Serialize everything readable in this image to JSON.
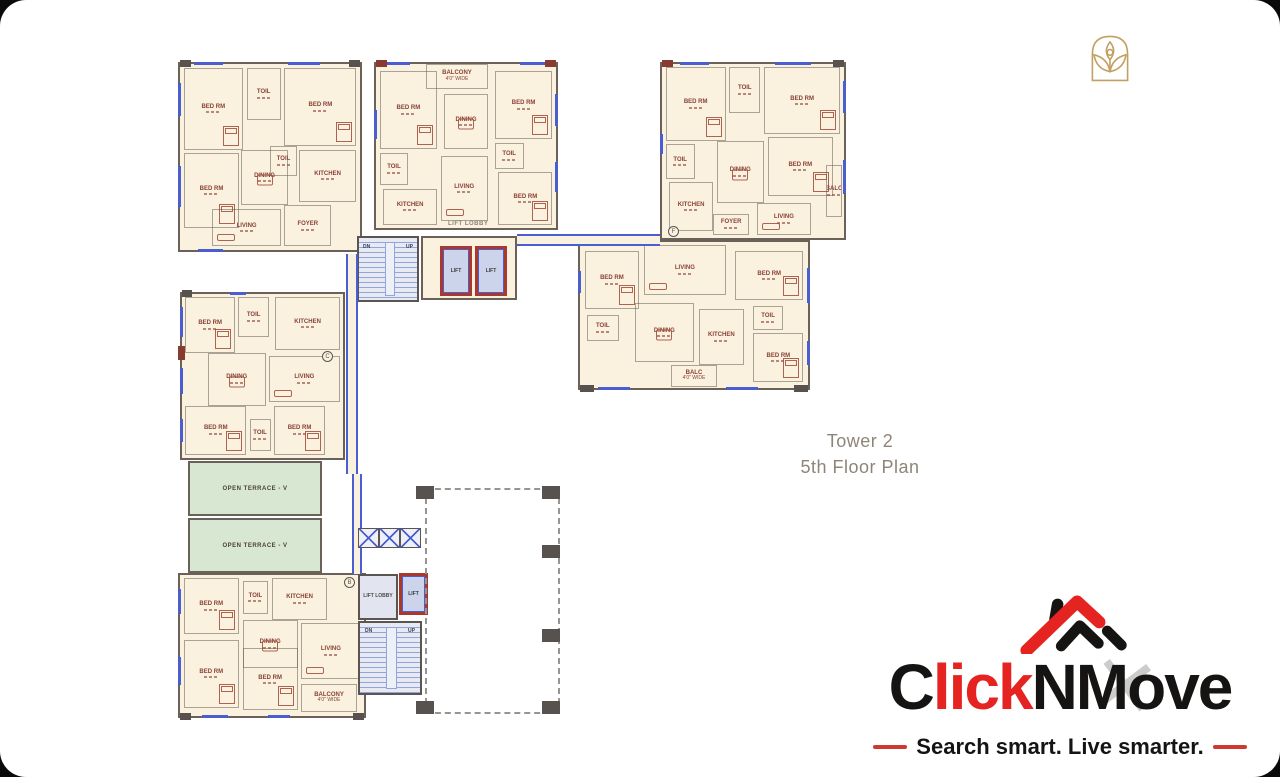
{
  "plan": {
    "title": {
      "line1": "Tower 2",
      "line2": "5th Floor Plan"
    },
    "labels": {
      "lift_lobby": "LIFT LOBBY",
      "lift": "LIFT",
      "up": "UP",
      "dn": "DN"
    },
    "terraces": [
      {
        "label": "OPEN TERRACE - V",
        "x": 188,
        "y": 461,
        "w": 134,
        "h": 55
      },
      {
        "label": "OPEN TERRACE - V",
        "x": 188,
        "y": 518,
        "w": 134,
        "h": 55
      }
    ],
    "markers": [
      {
        "letter": "F",
        "x": 668,
        "y": 226
      },
      {
        "letter": "B",
        "x": 344,
        "y": 577
      },
      {
        "letter": "C",
        "x": 322,
        "y": 351
      }
    ],
    "wings": [
      {
        "name": "wing-top-left",
        "x": 178,
        "y": 62,
        "w": 184,
        "h": 190,
        "rooms": [
          {
            "label": "BED RM",
            "x": 2,
            "y": 2,
            "w": 33,
            "h": 44,
            "furn": "bed"
          },
          {
            "label": "TOIL",
            "x": 37,
            "y": 2,
            "w": 19,
            "h": 28
          },
          {
            "label": "BED RM",
            "x": 58,
            "y": 2,
            "w": 40,
            "h": 42,
            "furn": "bed"
          },
          {
            "label": "BED RM",
            "x": 2,
            "y": 48,
            "w": 31,
            "h": 40,
            "furn": "bed"
          },
          {
            "label": "TOIL",
            "x": 50,
            "y": 44,
            "w": 15,
            "h": 16
          },
          {
            "label": "DINING",
            "x": 34,
            "y": 46,
            "w": 26,
            "h": 30,
            "furn": "table"
          },
          {
            "label": "KITCHEN",
            "x": 66,
            "y": 46,
            "w": 32,
            "h": 28
          },
          {
            "label": "LIVING",
            "x": 18,
            "y": 78,
            "w": 38,
            "h": 20,
            "furn": "sofa"
          },
          {
            "label": "FOYER",
            "x": 58,
            "y": 76,
            "w": 26,
            "h": 22
          }
        ],
        "windows": [
          {
            "s": "top",
            "p": 8,
            "l": 16
          },
          {
            "s": "top",
            "p": 60,
            "l": 18
          },
          {
            "s": "left",
            "p": 10,
            "l": 18
          },
          {
            "s": "left",
            "p": 55,
            "l": 22
          },
          {
            "s": "bottom",
            "p": 10,
            "l": 14
          },
          {
            "s": "top",
            "p": 0,
            "l": 6,
            "t": "col",
            "c": "#57524e"
          },
          {
            "s": "top",
            "p": 94,
            "l": 6,
            "t": "col",
            "c": "#57524e"
          }
        ]
      },
      {
        "name": "wing-top-middle",
        "x": 374,
        "y": 62,
        "w": 184,
        "h": 168,
        "rooms": [
          {
            "label": "BALCONY",
            "dim": "4'0\" WIDE",
            "x": 28,
            "y": 0,
            "w": 34,
            "h": 15
          },
          {
            "label": "BED RM",
            "x": 2,
            "y": 4,
            "w": 32,
            "h": 48,
            "furn": "bed"
          },
          {
            "label": "BED RM",
            "x": 66,
            "y": 4,
            "w": 32,
            "h": 42,
            "furn": "bed"
          },
          {
            "label": "DINING",
            "x": 38,
            "y": 18,
            "w": 24,
            "h": 34,
            "furn": "table"
          },
          {
            "label": "TOIL",
            "x": 2,
            "y": 54,
            "w": 16,
            "h": 20
          },
          {
            "label": "KITCHEN",
            "x": 4,
            "y": 76,
            "w": 30,
            "h": 22
          },
          {
            "label": "LIVING",
            "x": 36,
            "y": 56,
            "w": 26,
            "h": 40,
            "furn": "sofa"
          },
          {
            "label": "TOIL",
            "x": 66,
            "y": 48,
            "w": 16,
            "h": 16
          },
          {
            "label": "BED RM",
            "x": 68,
            "y": 66,
            "w": 30,
            "h": 32,
            "furn": "bed"
          }
        ],
        "windows": [
          {
            "s": "top",
            "p": 5,
            "l": 14
          },
          {
            "s": "top",
            "p": 80,
            "l": 14
          },
          {
            "s": "left",
            "p": 28,
            "l": 18
          },
          {
            "s": "right",
            "p": 18,
            "l": 20
          },
          {
            "s": "right",
            "p": 60,
            "l": 18
          },
          {
            "s": "top",
            "p": 0,
            "l": 6,
            "t": "col",
            "c": "#8a3b31"
          },
          {
            "s": "top",
            "p": 94,
            "l": 6,
            "t": "col",
            "c": "#8a3b31"
          }
        ]
      },
      {
        "name": "wing-top-right",
        "x": 660,
        "y": 62,
        "w": 186,
        "h": 178,
        "rooms": [
          {
            "label": "BED RM",
            "x": 2,
            "y": 2,
            "w": 33,
            "h": 42,
            "furn": "bed"
          },
          {
            "label": "TOIL",
            "x": 37,
            "y": 2,
            "w": 17,
            "h": 26
          },
          {
            "label": "BED RM",
            "x": 56,
            "y": 2,
            "w": 42,
            "h": 38,
            "furn": "bed"
          },
          {
            "label": "TOIL",
            "x": 2,
            "y": 46,
            "w": 16,
            "h": 20
          },
          {
            "label": "KITCHEN",
            "x": 4,
            "y": 68,
            "w": 24,
            "h": 28
          },
          {
            "label": "DINING",
            "x": 30,
            "y": 44,
            "w": 26,
            "h": 36,
            "furn": "table"
          },
          {
            "label": "BED RM",
            "x": 58,
            "y": 42,
            "w": 36,
            "h": 34,
            "furn": "bed"
          },
          {
            "label": "LIVING",
            "x": 52,
            "y": 80,
            "w": 30,
            "h": 18,
            "furn": "sofa"
          },
          {
            "label": "FOYER",
            "x": 28,
            "y": 86,
            "w": 20,
            "h": 12
          },
          {
            "label": "BALC",
            "x": 90,
            "y": 58,
            "w": 9,
            "h": 30
          }
        ],
        "windows": [
          {
            "s": "top",
            "p": 10,
            "l": 16
          },
          {
            "s": "top",
            "p": 62,
            "l": 20
          },
          {
            "s": "right",
            "p": 10,
            "l": 18
          },
          {
            "s": "right",
            "p": 55,
            "l": 20
          },
          {
            "s": "left",
            "p": 40,
            "l": 12
          },
          {
            "s": "top",
            "p": 0,
            "l": 6,
            "t": "col",
            "c": "#8a3b31"
          },
          {
            "s": "top",
            "p": 94,
            "l": 6,
            "t": "col",
            "c": "#57524e"
          }
        ]
      },
      {
        "name": "wing-middle-right",
        "x": 578,
        "y": 240,
        "w": 232,
        "h": 150,
        "rooms": [
          {
            "label": "BED RM",
            "x": 2,
            "y": 6,
            "w": 24,
            "h": 40,
            "furn": "bed"
          },
          {
            "label": "LIVING",
            "x": 28,
            "y": 2,
            "w": 36,
            "h": 34,
            "furn": "sofa"
          },
          {
            "label": "BED RM",
            "x": 68,
            "y": 6,
            "w": 30,
            "h": 34,
            "furn": "bed"
          },
          {
            "label": "TOIL",
            "x": 3,
            "y": 50,
            "w": 14,
            "h": 18
          },
          {
            "label": "DINING",
            "x": 24,
            "y": 42,
            "w": 26,
            "h": 40,
            "furn": "table"
          },
          {
            "label": "KITCHEN",
            "x": 52,
            "y": 46,
            "w": 20,
            "h": 38
          },
          {
            "label": "TOIL",
            "x": 76,
            "y": 44,
            "w": 13,
            "h": 16
          },
          {
            "label": "BED RM",
            "x": 76,
            "y": 62,
            "w": 22,
            "h": 34,
            "furn": "bed"
          },
          {
            "label": "BALC",
            "dim": "4'0\" WIDE",
            "x": 40,
            "y": 84,
            "w": 20,
            "h": 15
          }
        ],
        "windows": [
          {
            "s": "bottom",
            "p": 8,
            "l": 14
          },
          {
            "s": "bottom",
            "p": 64,
            "l": 14
          },
          {
            "s": "left",
            "p": 20,
            "l": 15
          },
          {
            "s": "right",
            "p": 18,
            "l": 24
          },
          {
            "s": "right",
            "p": 68,
            "l": 16
          },
          {
            "s": "bottom",
            "p": 0,
            "l": 6,
            "t": "col",
            "c": "#57524e"
          },
          {
            "s": "bottom",
            "p": 94,
            "l": 6,
            "t": "col",
            "c": "#57524e"
          }
        ]
      },
      {
        "name": "wing-middle-left",
        "x": 180,
        "y": 292,
        "w": 165,
        "h": 168,
        "rooms": [
          {
            "label": "BED RM",
            "x": 2,
            "y": 2,
            "w": 31,
            "h": 34,
            "furn": "bed"
          },
          {
            "label": "TOIL",
            "x": 35,
            "y": 2,
            "w": 19,
            "h": 24
          },
          {
            "label": "KITCHEN",
            "x": 58,
            "y": 2,
            "w": 40,
            "h": 32
          },
          {
            "label": "DINING",
            "x": 16,
            "y": 36,
            "w": 36,
            "h": 32,
            "furn": "table"
          },
          {
            "label": "LIVING",
            "x": 54,
            "y": 38,
            "w": 44,
            "h": 28,
            "furn": "sofa"
          },
          {
            "label": "BED RM",
            "x": 2,
            "y": 68,
            "w": 38,
            "h": 30,
            "furn": "bed"
          },
          {
            "label": "TOIL",
            "x": 42,
            "y": 76,
            "w": 13,
            "h": 20
          },
          {
            "label": "BED RM",
            "x": 57,
            "y": 68,
            "w": 32,
            "h": 30,
            "furn": "bed"
          }
        ],
        "windows": [
          {
            "s": "left",
            "p": 8,
            "l": 18
          },
          {
            "s": "left",
            "p": 45,
            "l": 16
          },
          {
            "s": "left",
            "p": 76,
            "l": 14
          },
          {
            "s": "top",
            "p": 30,
            "l": 10
          },
          {
            "s": "left",
            "p": 32,
            "l": 8,
            "t": "col",
            "c": "#8a3b31"
          },
          {
            "s": "top",
            "p": 0,
            "l": 6,
            "t": "col",
            "c": "#57524e"
          }
        ]
      },
      {
        "name": "wing-bottom-left",
        "x": 178,
        "y": 573,
        "w": 188,
        "h": 145,
        "rooms": [
          {
            "label": "BED RM",
            "x": 2,
            "y": 2,
            "w": 30,
            "h": 40,
            "furn": "bed"
          },
          {
            "label": "TOIL",
            "x": 34,
            "y": 4,
            "w": 14,
            "h": 24
          },
          {
            "label": "KITCHEN",
            "x": 50,
            "y": 2,
            "w": 30,
            "h": 30
          },
          {
            "label": "DINING",
            "x": 34,
            "y": 32,
            "w": 30,
            "h": 34,
            "furn": "table"
          },
          {
            "label": "LIVING",
            "x": 66,
            "y": 34,
            "w": 32,
            "h": 40,
            "furn": "sofa"
          },
          {
            "label": "BED RM",
            "x": 2,
            "y": 46,
            "w": 30,
            "h": 48,
            "furn": "bed"
          },
          {
            "label": "BED RM",
            "x": 34,
            "y": 52,
            "w": 30,
            "h": 44,
            "furn": "bed"
          },
          {
            "label": "BALCONY",
            "dim": "4'0\" WIDE",
            "x": 66,
            "y": 77,
            "w": 30,
            "h": 20
          }
        ],
        "windows": [
          {
            "s": "left",
            "p": 10,
            "l": 18
          },
          {
            "s": "left",
            "p": 58,
            "l": 20
          },
          {
            "s": "bottom",
            "p": 12,
            "l": 14
          },
          {
            "s": "bottom",
            "p": 48,
            "l": 12
          },
          {
            "s": "bottom",
            "p": 0,
            "l": 6,
            "t": "col",
            "c": "#57524e"
          },
          {
            "s": "bottom",
            "p": 94,
            "l": 6,
            "t": "col",
            "c": "#57524e"
          }
        ]
      }
    ]
  },
  "branding": {
    "emblem_color": "#c2a061",
    "logo": {
      "part1": "C",
      "part2": "lick",
      "part3": "NMove",
      "tagline": "Search smart. Live smarter.",
      "watermark_glyph": "✕",
      "red": "#e52320",
      "black": "#161413"
    }
  }
}
